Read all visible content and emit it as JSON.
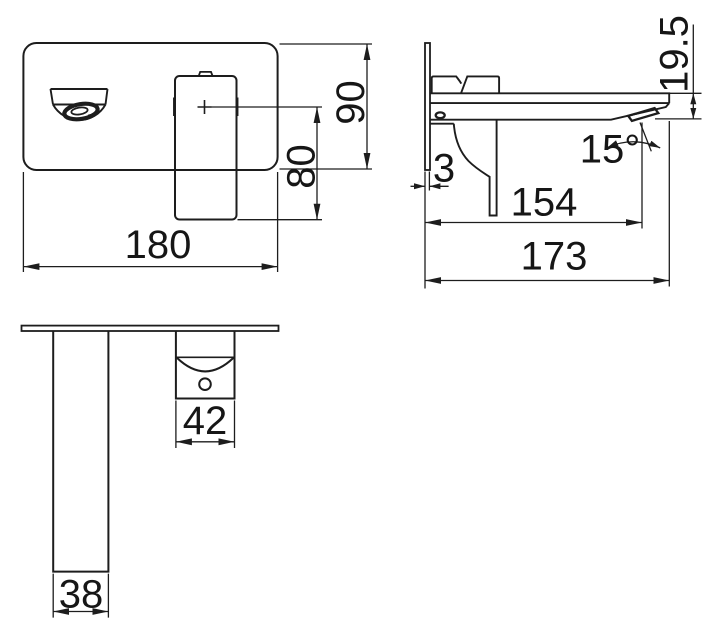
{
  "page": {
    "background": "#ffffff",
    "description": "Technical dimension drawing of a wall-mounted basin mixer tap, three orthographic views"
  },
  "colors": {
    "line": "#1d1d1d",
    "text": "#161616"
  },
  "views": {
    "front": {
      "dims": {
        "plate_width": "180",
        "plate_height": "90",
        "handle_height": "80"
      }
    },
    "side": {
      "dims": {
        "plate_thickness": "3",
        "tip_depth": "19.5",
        "spout_angle": "15°",
        "wall_to_outlet": "154",
        "wall_to_tip": "173"
      }
    },
    "bottom": {
      "dims": {
        "handle_width": "42",
        "spout_width": "38"
      }
    }
  }
}
